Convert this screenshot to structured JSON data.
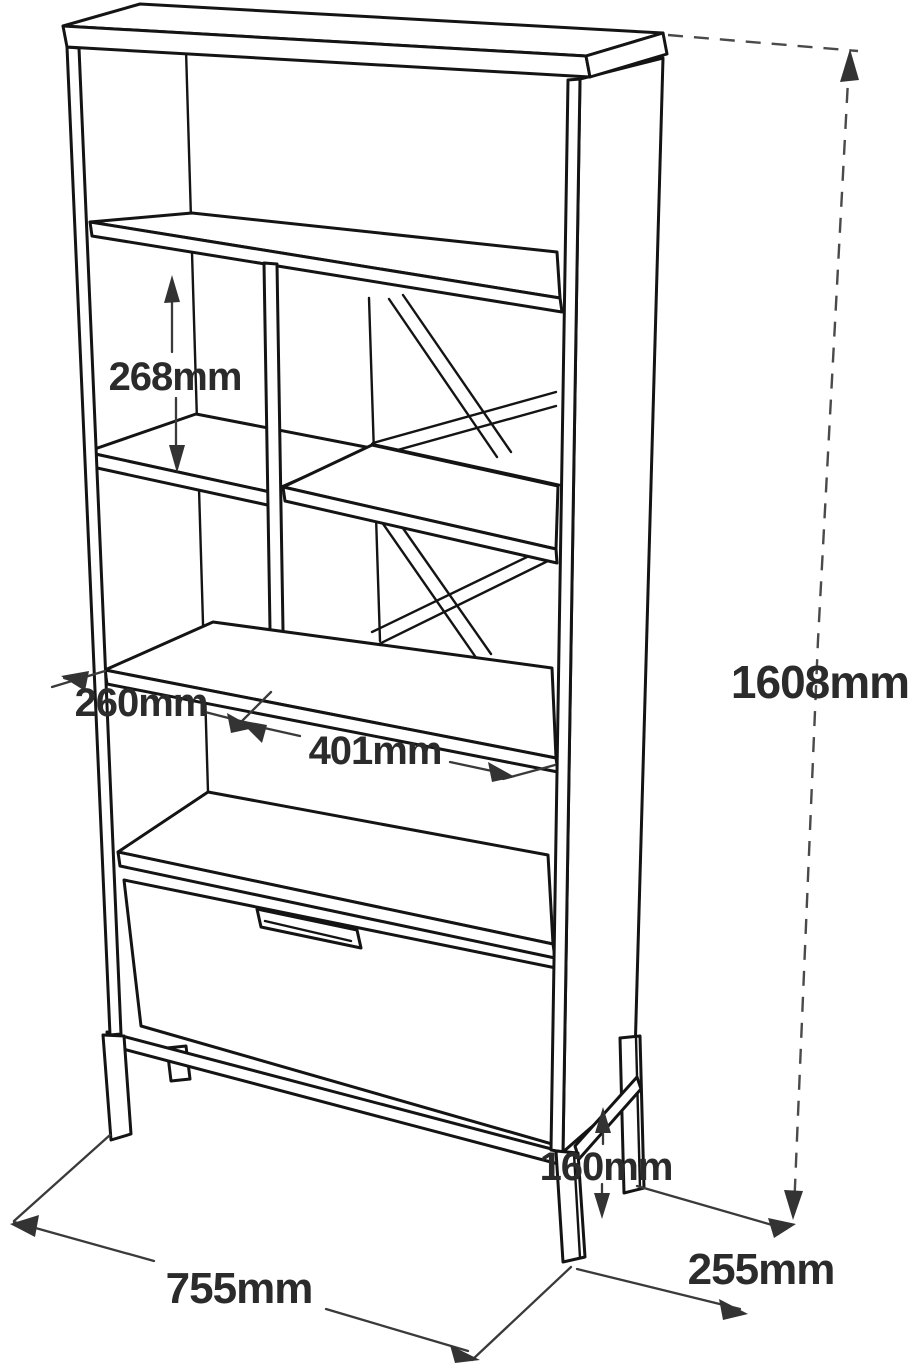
{
  "diagram": {
    "type": "furniture-dimension-drawing",
    "subject": "bookcase-with-drawer",
    "dimensions": {
      "inner_shelf_height": "268mm",
      "left_section_width": "260mm",
      "right_section_width": "401mm",
      "overall_height": "1608mm",
      "leg_height": "160mm",
      "overall_width": "755mm",
      "overall_depth": "255mm"
    },
    "colors": {
      "line": "#141414",
      "dimension_line": "#3a3a3a",
      "label_text": "#2b2b2b",
      "background": "#ffffff"
    }
  }
}
